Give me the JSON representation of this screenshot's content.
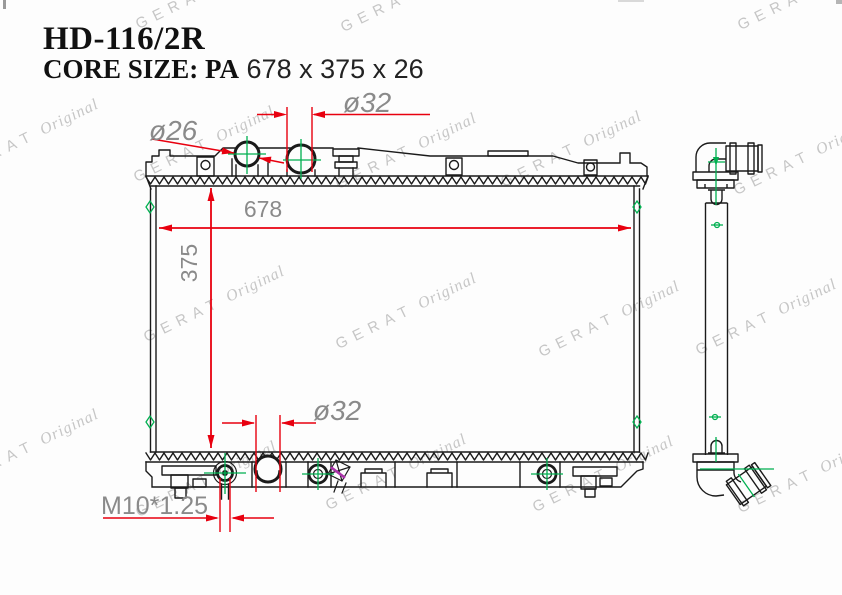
{
  "header": {
    "part_number": "HD-116/2R",
    "core_size_prefix": "CORE SIZE: PA",
    "core_size_value": "678 x 375 x 26"
  },
  "watermark": {
    "brand": "GERAT",
    "suffix": "Original"
  },
  "dimensions": {
    "top_left_port_diameter": "ø26",
    "top_right_port_diameter": "ø32",
    "core_width": "678",
    "core_height": "375",
    "bottom_port_diameter": "ø32",
    "drain_plug_thread": "M10*1.25"
  },
  "colors": {
    "dimension_red": "#e8000f",
    "centerline_green": "#00b050",
    "label_gray": "#8a8a8a",
    "line_black": "#1a1a1a",
    "watermark_gray": "#c6c6c6",
    "sensor_magenta": "#aa33aa"
  }
}
